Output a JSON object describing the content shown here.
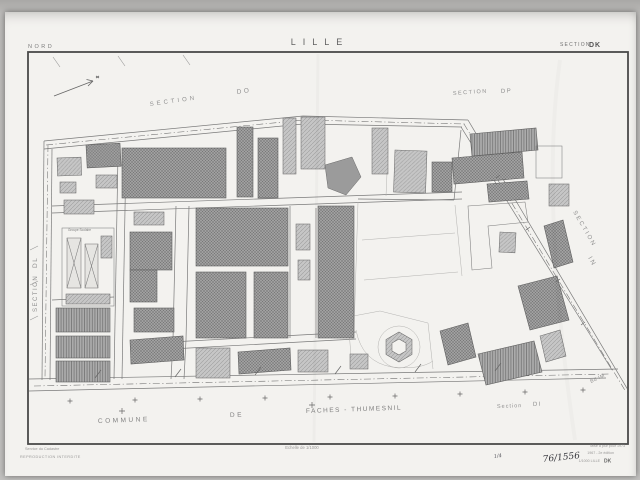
{
  "header": {
    "region_label": "NORD",
    "title": "LILLE",
    "sheet_prefix": "SECTION",
    "sheet_code": "DK"
  },
  "map": {
    "sections": {
      "do": {
        "word": "SECTION",
        "code": "DO"
      },
      "dp": {
        "word": "SECTION",
        "code": "DP"
      },
      "in": {
        "word": "SECTION",
        "code": "IN"
      },
      "dl": {
        "word": "SECTION",
        "code": "DL"
      },
      "di": {
        "word": "Section",
        "code": "DI"
      }
    },
    "road_label": "Bd IM",
    "school_label": "Groupe Scolaire",
    "commune": {
      "word1": "COMMUNE",
      "word2": "DE",
      "word3": "FACHES - THUMESNIL"
    },
    "icons": {
      "north_arrow": "north-arrow"
    }
  },
  "footer": {
    "service_line": "Service du Cadastre",
    "reproduction_line": "REPRODUCTION INTERDITE",
    "scale_label": "Echelle de 1/1000",
    "edition_line1": "Mise à jour pour 1973",
    "edition_line2": "1967 - 2e édition",
    "edition_line3": "1/1000 LILLE",
    "edition_sheet": "DK",
    "handwritten_small": "1/4",
    "handwritten_ref": "76/1556"
  },
  "colors": {
    "paper": "#f3f2ef",
    "background": "#bdbcba",
    "frame_ink": "#4a4a4a",
    "line_ink": "#7a7a7a",
    "building_dark": "#a0a0a0",
    "building_medium": "#c6c6c6",
    "label_gray": "#8f8f8f"
  }
}
